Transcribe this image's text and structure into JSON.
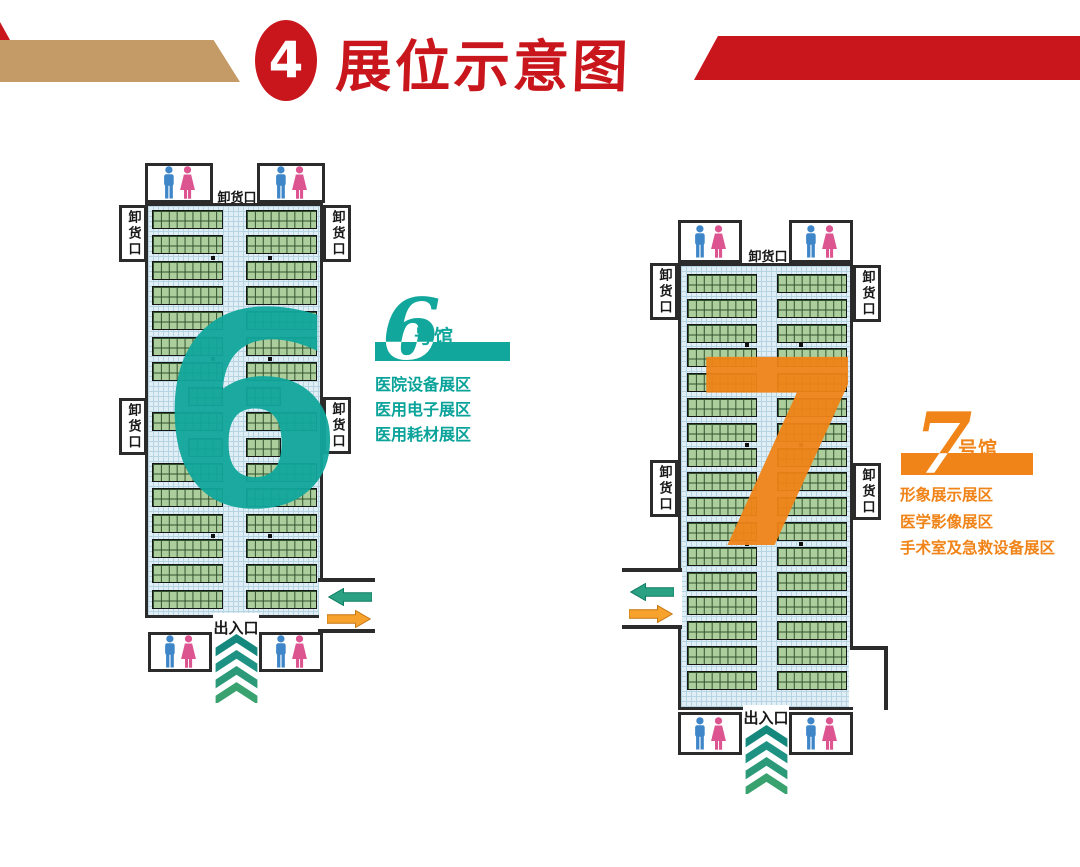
{
  "header": {
    "badge_number": "4",
    "title": "展位示意图",
    "red": "#c9161d",
    "tan": "#c49a67"
  },
  "halls": [
    {
      "name": "6号馆",
      "big_number": "6",
      "label_digit": "6",
      "label_suffix": "号馆",
      "theme_color": "#12a79c",
      "text_color": "#0aa39a",
      "areas": [
        "医院设备展区",
        "医用电子展区",
        "医用耗材展区"
      ],
      "dock_label": "卸货口",
      "entrance_label": "出入口",
      "floorplan": {
        "rows": 16,
        "short_rows": [
          7,
          9
        ],
        "columns": 2,
        "cells_per_strip": 9
      }
    },
    {
      "name": "7号馆",
      "big_number": "7",
      "label_digit": "7",
      "label_suffix": "号馆",
      "theme_color": "#f08418",
      "text_color": "#f08418",
      "areas": [
        "形象展示展区",
        "医学影像展区",
        "手术室及急救设备展区"
      ],
      "dock_label": "卸货口",
      "entrance_label": "出入口",
      "floorplan": {
        "rows": 17,
        "short_rows": [],
        "columns": 2,
        "cells_per_strip": 9
      }
    }
  ],
  "colors": {
    "wall": "#2b2b2b",
    "booth_fill": "#accd9c",
    "booth_line": "#31522e",
    "floor_bg": "#e0eef6",
    "floor_line": "#b7d4e3"
  },
  "icons": {
    "male_color": "#3f86c9",
    "female_color": "#dc5590",
    "arrow_in_color": "#2aa182",
    "arrow_in_edge": "#0d7a63",
    "arrow_out_color": "#f6a22d",
    "arrow_out_edge": "#c67712",
    "chevron_colors": [
      "#15887e",
      "#1e9283",
      "#2c9a79",
      "#3aa26f"
    ]
  }
}
